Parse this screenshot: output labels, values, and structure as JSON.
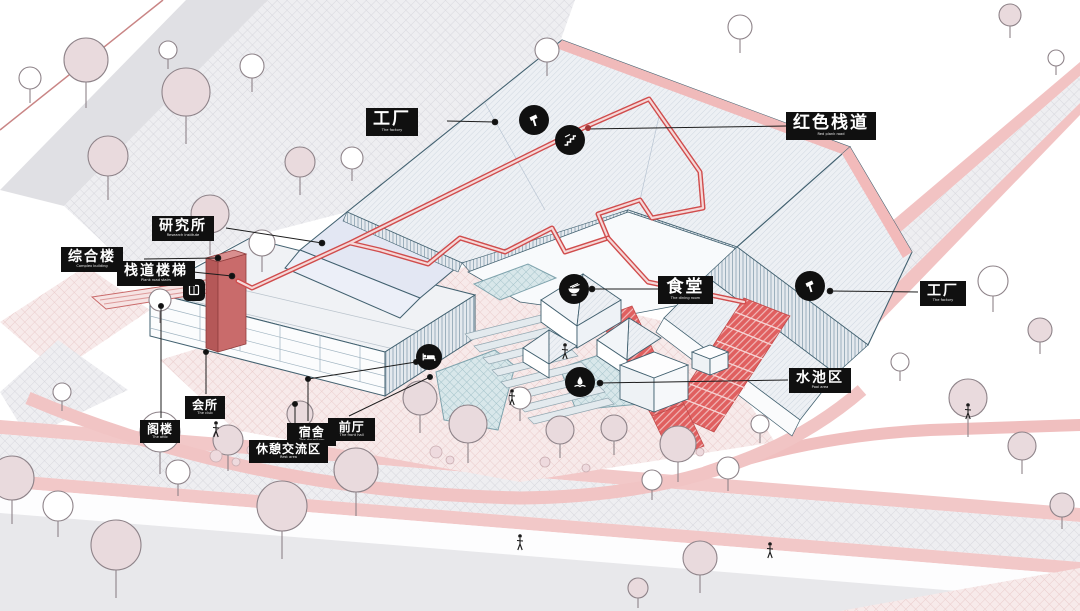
{
  "diagram": {
    "type": "architectural-axonometric-site-diagram",
    "language": "zh-CN"
  },
  "labels": [
    {
      "id": "factory-top",
      "zh": "工厂",
      "en": "The factory"
    },
    {
      "id": "red-plank-road",
      "zh": "红色栈道",
      "en": "Red plank road"
    },
    {
      "id": "research-institute",
      "zh": "研究所",
      "en": "Research institute"
    },
    {
      "id": "complex-building",
      "zh": "综合楼",
      "en": "Complex building"
    },
    {
      "id": "plank-road-stairs",
      "zh": "栈道楼梯",
      "en": "Plank road stairs"
    },
    {
      "id": "dining-room",
      "zh": "食堂",
      "en": "The dining room"
    },
    {
      "id": "factory-right",
      "zh": "工厂",
      "en": "The factory"
    },
    {
      "id": "pool-area",
      "zh": "水池区",
      "en": "Pool area"
    },
    {
      "id": "club",
      "zh": "会所",
      "en": "The club"
    },
    {
      "id": "attic",
      "zh": "阁楼",
      "en": "The attic"
    },
    {
      "id": "dormitory",
      "zh": "宿舍",
      "en": "The dormitory"
    },
    {
      "id": "rest-area",
      "zh": "休憩交流区",
      "en": "Rest area"
    },
    {
      "id": "front-hall",
      "zh": "前厅",
      "en": "The front hall"
    }
  ],
  "icons": {
    "factory": "hammer-icon",
    "red_plank_road": "stairs-icon",
    "dining_room": "noodle-bowl-icon",
    "pool_area": "fountain-icon",
    "dormitory": "bed-icon",
    "stair_tower": "elevator-badge-icon",
    "pedestrian": "person-figure"
  },
  "colors": {
    "label_background": "#101010",
    "label_text": "#ffffff",
    "red_walkway": "#d04c4c",
    "building_outline": "#426170",
    "pool_fill": "#d8e7ea",
    "tree_fill_pink": "#e9dadd",
    "road_edge_pink": "#f2c8c8",
    "ground_hatch_gray": "#eeeef1",
    "stair_tower_red": "#c96b6b"
  }
}
